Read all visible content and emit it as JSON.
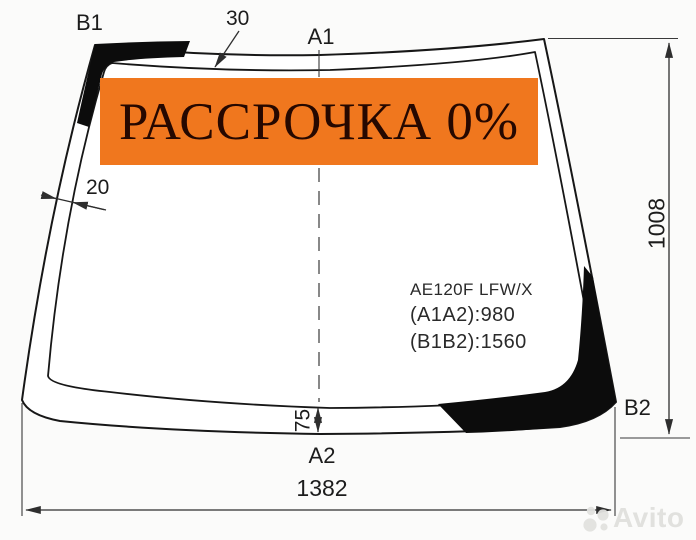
{
  "banner": {
    "text": "РАССРОЧКА 0%",
    "bg_color": "#f0771e",
    "text_color": "#260800"
  },
  "corner_labels": {
    "top_left": "B1",
    "top_center": "A1",
    "bottom_center": "A2",
    "bottom_right": "B2"
  },
  "dimensions": {
    "top_band_width": "30",
    "side_band_width": "20",
    "bottom_band_width": "75",
    "overall_height": "1008",
    "overall_width": "1382"
  },
  "part_info": {
    "model": "AE120F LFW/X",
    "a_distance": "(A1A2):980",
    "b_distance": "(B1B2):1560"
  },
  "watermark": {
    "brand": "Avito",
    "logo": "avito-dots-logo",
    "color": "#e0e0dd"
  },
  "colors": {
    "outline": "#171717",
    "background": "#fbfbfa"
  }
}
